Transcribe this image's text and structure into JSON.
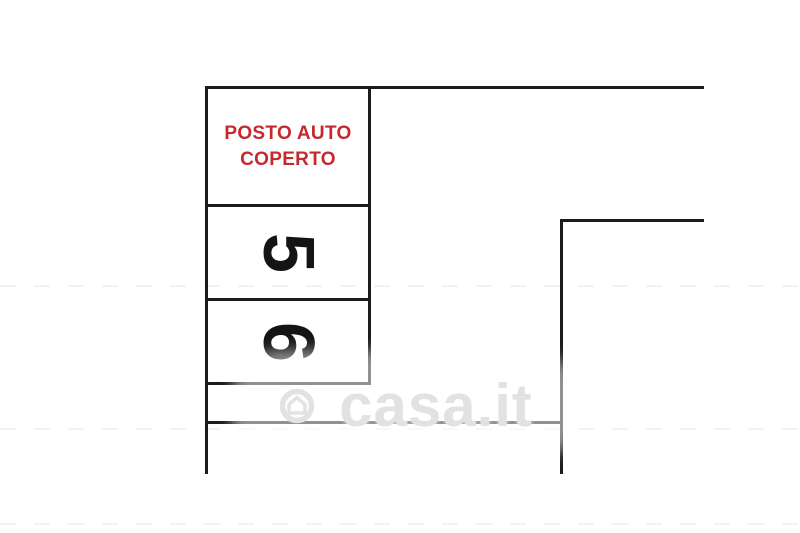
{
  "theme": {
    "canvas_bg": "#ffffff",
    "line_color": "#1b1b1b",
    "label_red": "#c5292d",
    "watermark_gray": "#e2e2e2"
  },
  "floorplan": {
    "covered_spot_label": {
      "line1": "POSTO AUTO",
      "line2": "COPERTO"
    },
    "spots": [
      {
        "number": "5"
      },
      {
        "number": "6"
      }
    ]
  },
  "watermark": {
    "text": "casa.it",
    "logo_icon": "casa-it-house-logo"
  }
}
